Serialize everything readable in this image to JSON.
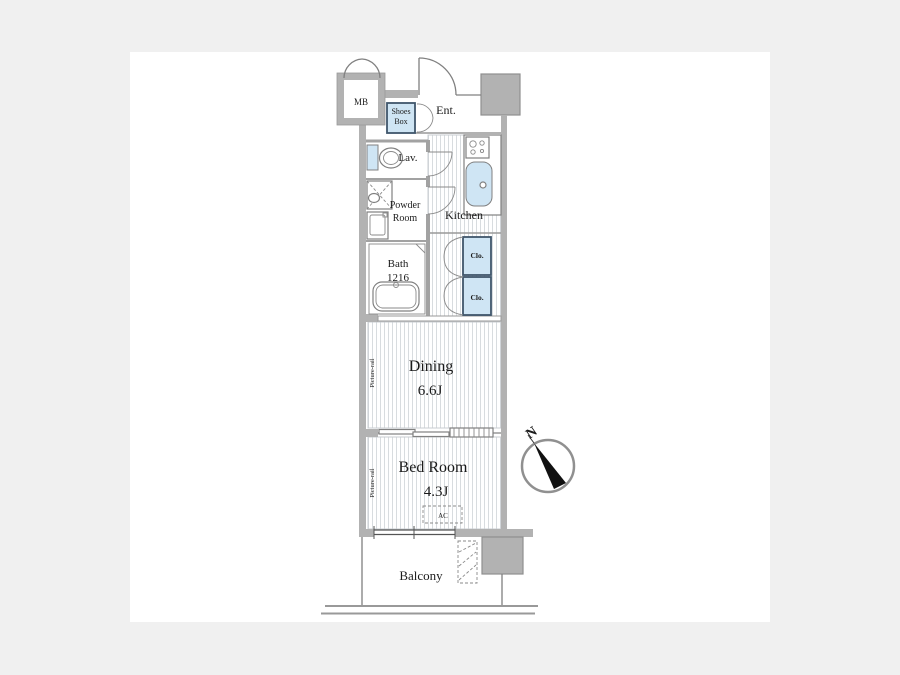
{
  "floorplan": {
    "colors": {
      "page_background": "#f0f0f0",
      "canvas": "#ffffff",
      "wall": "#b2b2b2",
      "pillar": "#c4c4c4",
      "highlight": "#cfe5f4",
      "highlight_border": "#3f566b",
      "line": "#808080",
      "text": "#1b1b1b",
      "floor_stripe": "#d8dcdf",
      "compass_needle": "#111111"
    },
    "labels": {
      "meter_box": "MB",
      "shoes_box_line1": "Shoes",
      "shoes_box_line2": "Box",
      "entrance": "Ent.",
      "lavatory": "Lav.",
      "powder_room_line1": "Powder",
      "powder_room_line2": "Room",
      "kitchen": "Kitchen",
      "bath_line1": "Bath",
      "bath_line2": "1216",
      "closet_upper": "Clo.",
      "closet_lower": "Clo.",
      "dining": "Dining",
      "dining_size": "6.6J",
      "bedroom": "Bed Room",
      "bedroom_size": "4.3J",
      "picture_rail_dining": "Picture-rail",
      "picture_rail_bedroom": "Picture-rail",
      "air_conditioner": "AC",
      "balcony": "Balcony",
      "compass_north": "N"
    }
  }
}
